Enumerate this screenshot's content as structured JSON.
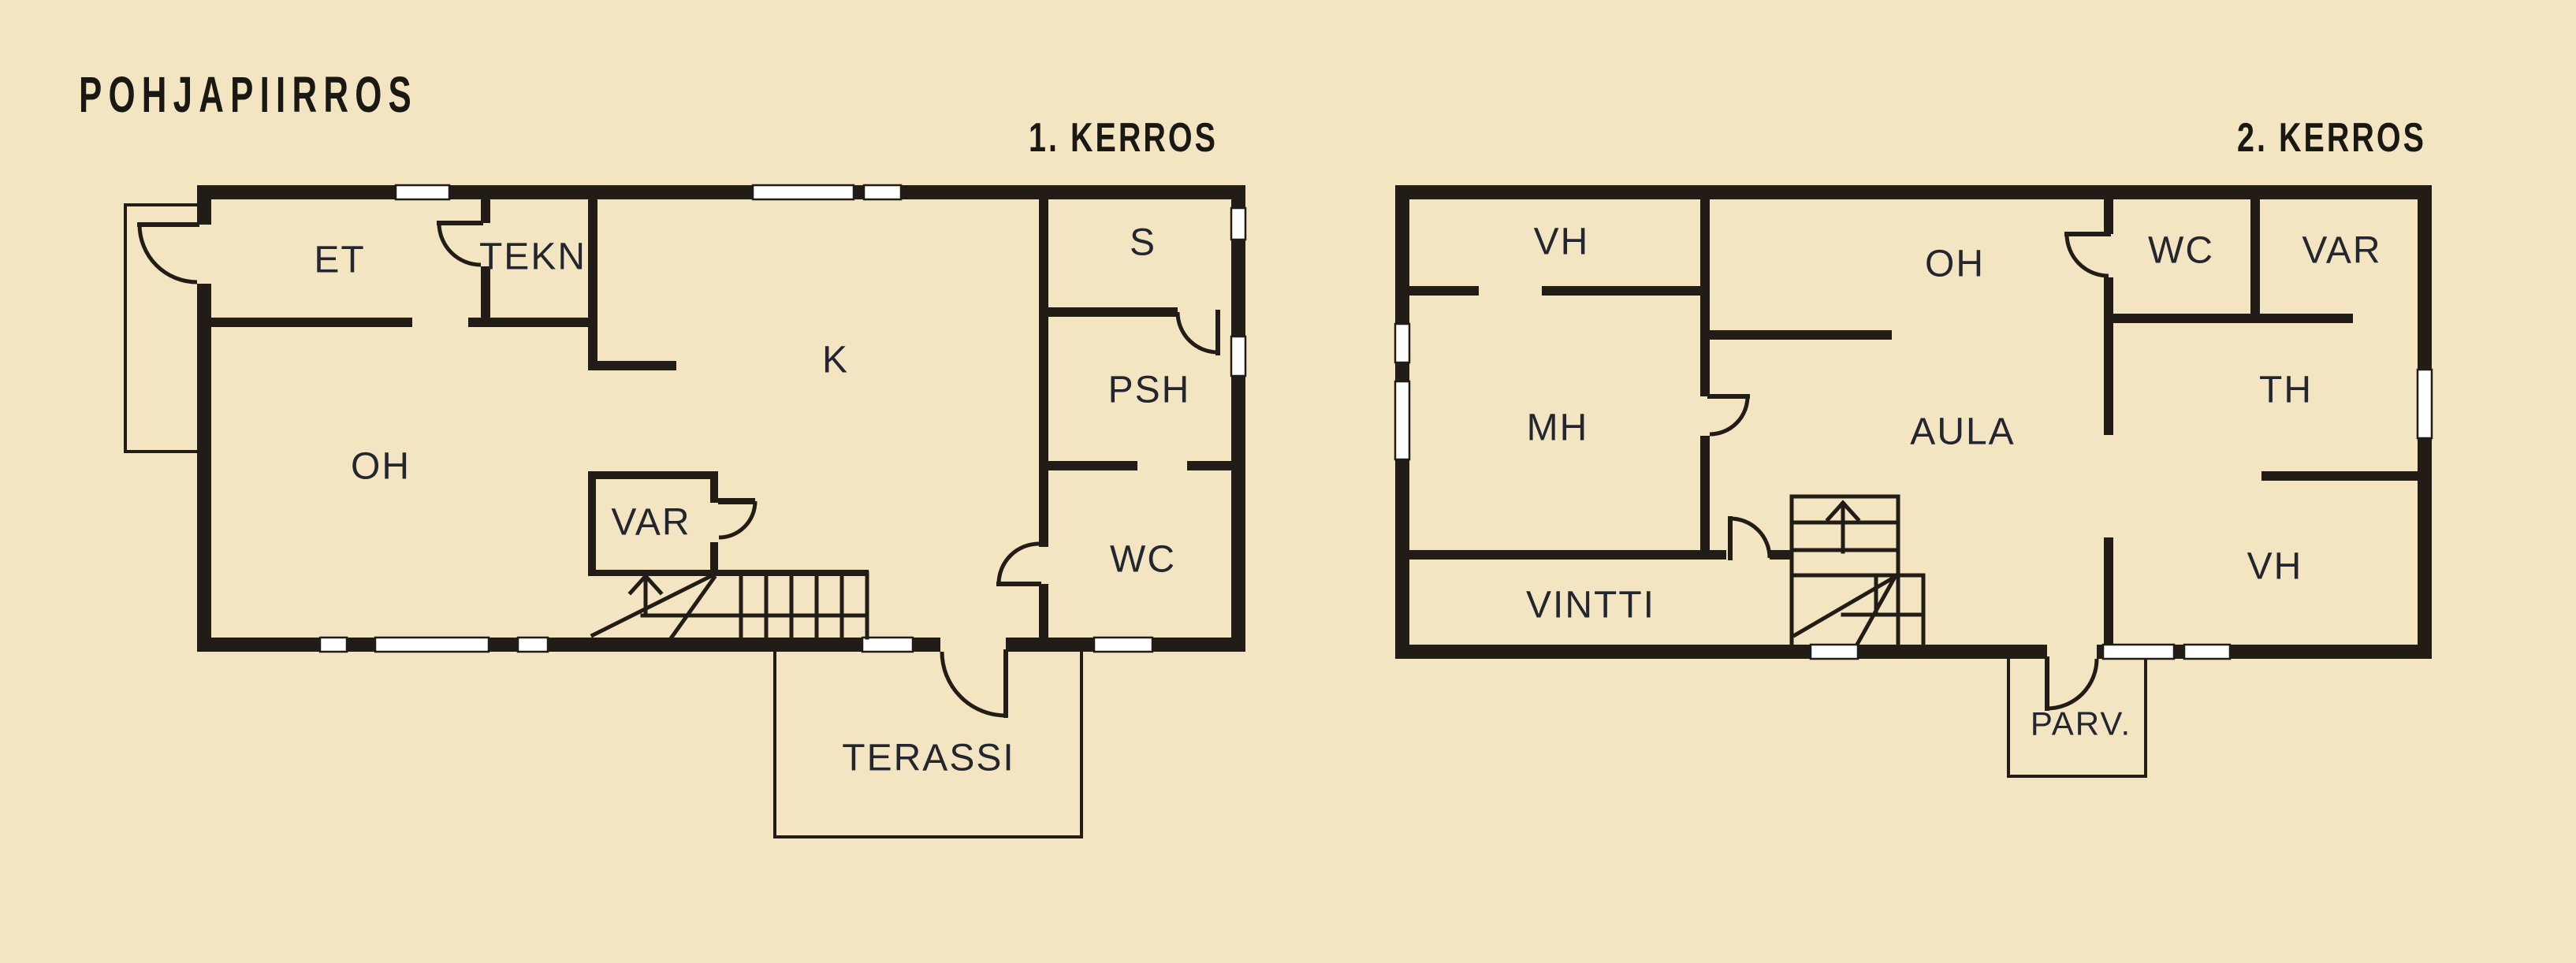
{
  "title": "POHJAPIIRROS",
  "colors": {
    "background": "#f3e5c1",
    "wall": "#211c16",
    "window": "#ffffff",
    "ink": "#23262e",
    "title_ink": "#191813"
  },
  "floor1": {
    "label": "1. KERROS",
    "rooms": {
      "et": "ET",
      "tekn": "TEKN",
      "k": "K",
      "s": "S",
      "psh": "PSH",
      "oh": "OH",
      "var": "VAR",
      "wc": "WC",
      "terassi": "TERASSI"
    }
  },
  "floor2": {
    "label": "2. KERROS",
    "rooms": {
      "vh_top": "VH",
      "oh": "OH",
      "wc": "WC",
      "var": "VAR",
      "mh": "MH",
      "aula": "AULA",
      "th": "TH",
      "vh_bottom": "VH",
      "vintti": "VINTTI",
      "parv": "PARV."
    }
  }
}
